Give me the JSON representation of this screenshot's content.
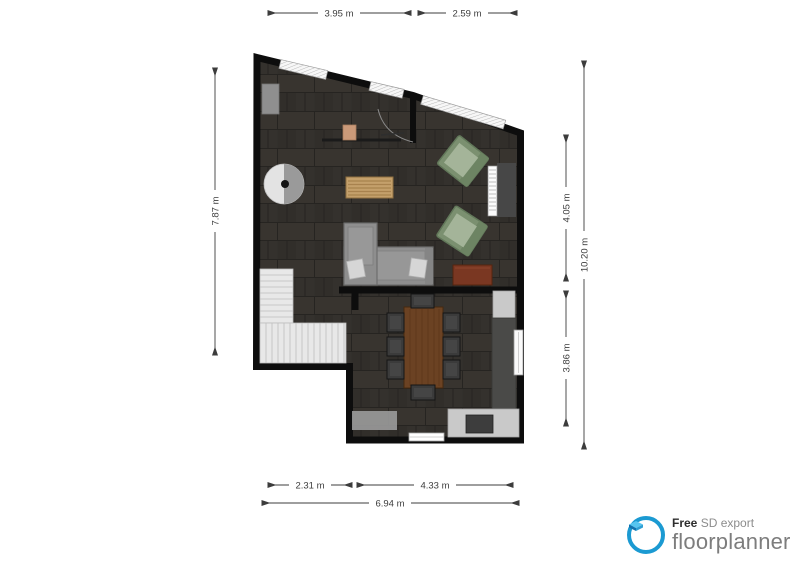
{
  "measurements": {
    "top": [
      {
        "label": "3.95 m"
      },
      {
        "label": "2.59 m"
      }
    ],
    "left": [
      {
        "label": "7.87 m"
      }
    ],
    "right": [
      {
        "label": "4.05 m"
      },
      {
        "label": "3.86 m"
      },
      {
        "label": "10.20 m"
      }
    ],
    "bottom": [
      {
        "label": "2.31 m"
      },
      {
        "label": "4.33 m"
      },
      {
        "label": "6.94 m"
      }
    ]
  },
  "logo": {
    "free_label": "Free",
    "export_label": "SD export",
    "brand": "floorplanner"
  },
  "plan": {
    "items": [
      "wall-cabinet",
      "round-side-table",
      "desk",
      "desk-stool",
      "coffee-table",
      "corner-sofa",
      "sofa-pillows",
      "sideboard",
      "armchair",
      "armchair",
      "radiator",
      "staircase",
      "dining-table",
      "dining-chairs",
      "kitchen-counter",
      "kitchen-tall-unit",
      "cooktop",
      "doormat",
      "back-door",
      "entry-door",
      "windows"
    ]
  },
  "colors": {
    "wall": "#0d0d0d",
    "floor": "#34312d",
    "window": "#f7f7f7",
    "stairs": "#e8e8e8",
    "sofa": "#8e8e8e",
    "armchair_green": "#7b9070",
    "armchair_green_inner": "#a4b499",
    "coffee_table": "#c4a06b",
    "dining_table": "#6b4223",
    "sideboard": "#7a3722",
    "counter": "#c9c9c9",
    "tall_unit": "#4a4a48",
    "stove": "#3d3d3d",
    "mat": "#9b9b9b",
    "dim_text": "#3c3c3c",
    "brand_blue": "#1b9ad2",
    "brand_gray": "#7d7d7d"
  }
}
